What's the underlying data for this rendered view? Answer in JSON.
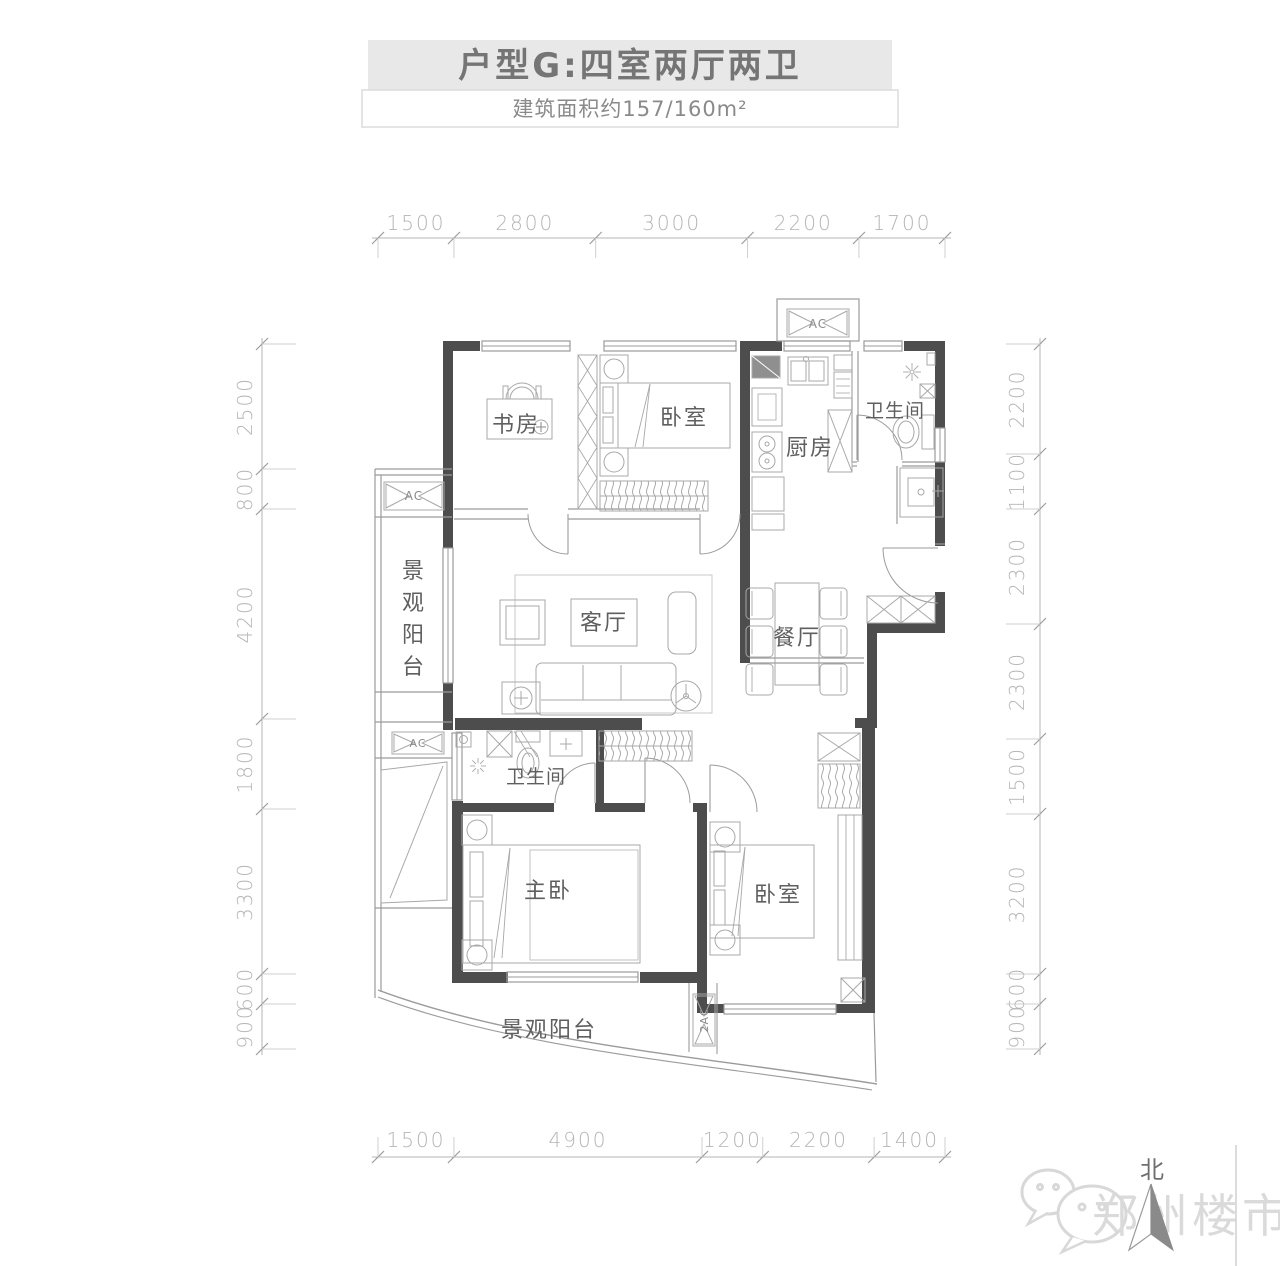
{
  "header": {
    "title": "户型G:四室两厅两卫",
    "subtitle": "建筑面积约157/160m²"
  },
  "floorplan": {
    "rooms": [
      {
        "name": "书房"
      },
      {
        "name": "卧室"
      },
      {
        "name": "厨房"
      },
      {
        "name": "卫生间"
      },
      {
        "name": "景观阳台"
      },
      {
        "name": "客厅"
      },
      {
        "name": "餐厅"
      },
      {
        "name": "卫生间"
      },
      {
        "name": "主卧"
      },
      {
        "name": "卧室"
      },
      {
        "name": "景观阳台"
      }
    ],
    "ac_units": {
      "left_top": "AC",
      "left_mid": "AC",
      "top": "AC",
      "bottom": "2AC"
    },
    "dimensions_mm": {
      "top": [
        1500,
        2800,
        3000,
        2200,
        1700
      ],
      "bottom": [
        1500,
        4900,
        1200,
        2200,
        1400
      ],
      "left": [
        2500,
        800,
        4200,
        1800,
        3300,
        600,
        900
      ],
      "right": [
        2200,
        1100,
        2300,
        2300,
        1500,
        3200,
        600,
        900
      ]
    },
    "compass_label": "北",
    "watermark_text": "郑州楼市"
  },
  "colors": {
    "wall": "#4d4d4d",
    "line": "#9b9b9b",
    "furniture": "#a8a8a8",
    "dim": "#b5b5b5",
    "title_bg": "#e8e8e8",
    "title_text": "#757575",
    "watermark": "#dadada"
  }
}
